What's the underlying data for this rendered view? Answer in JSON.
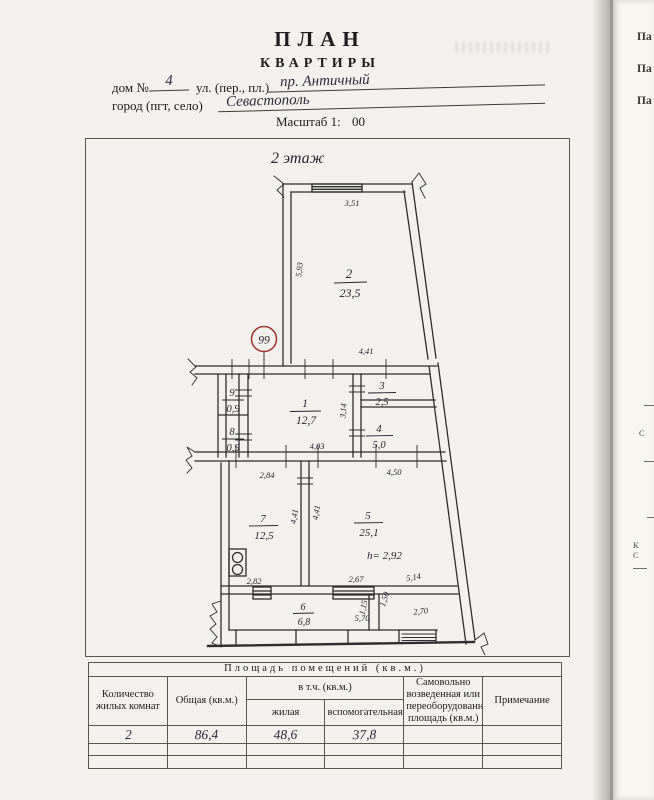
{
  "header": {
    "title1": "ПЛАН",
    "title2": "КВАРТИРЫ",
    "house_label": "дом №",
    "house_value": "4",
    "street_label": "ул. (пер., пл.)",
    "street_value": "пр. Античный",
    "city_label": "город (пгт, село)",
    "city_value": "Севастополь",
    "scale_label": "Масштаб 1:",
    "scale_suffix": "00"
  },
  "plan": {
    "floor_label": "2 этаж",
    "apartment_number": "99",
    "rooms": [
      {
        "number": "2",
        "area": "23,5"
      },
      {
        "number": "9",
        "area": "0,9"
      },
      {
        "number": "8",
        "area": "0,9"
      },
      {
        "number": "1",
        "area": "12,7"
      },
      {
        "number": "3",
        "area": "2,5"
      },
      {
        "number": "4",
        "area": "5,0"
      },
      {
        "number": "7",
        "area": "12,5"
      },
      {
        "number": "5",
        "area": "25,1"
      },
      {
        "number": "6",
        "area": "6,8"
      }
    ],
    "dims": {
      "room2_top": "3,51",
      "room2_left": "5,93",
      "room2_bottom": "4,41",
      "hall_width": "4,03",
      "hall_right": "3,14",
      "kitchen_top": "2,84",
      "room5_top": "4,50",
      "kitchen_right": "4,41",
      "room5_left": "4,41",
      "kitchen_bottom": "2,82",
      "room5_bottom": "2,67",
      "slant": "5,14",
      "corridor_bottom": "5,70",
      "bottom_right": "2,70",
      "passage_width": "1,15",
      "passage_height": "1,50",
      "ceiling_height": "h= 2,92"
    }
  },
  "table": {
    "title": "Площадь помещений (кв.м.)",
    "col_rooms": "Количество жилых комнат",
    "col_total": "Общая (кв.м.)",
    "col_incl": "в т.ч. (кв.м.)",
    "col_living": "жилая",
    "col_aux": "вспомогательная",
    "col_unauth": "Самовольно возведенная или переоборудованная площадь (кв.м.)",
    "col_note": "Примечание",
    "row": {
      "rooms": "2",
      "total": "86,4",
      "living": "48,6",
      "aux": "37,8"
    }
  },
  "adjacent_page": {
    "fragments": [
      "Па",
      "Па",
      "Па"
    ],
    "mid_fragments": [
      "С",
      "К",
      "С"
    ]
  }
}
